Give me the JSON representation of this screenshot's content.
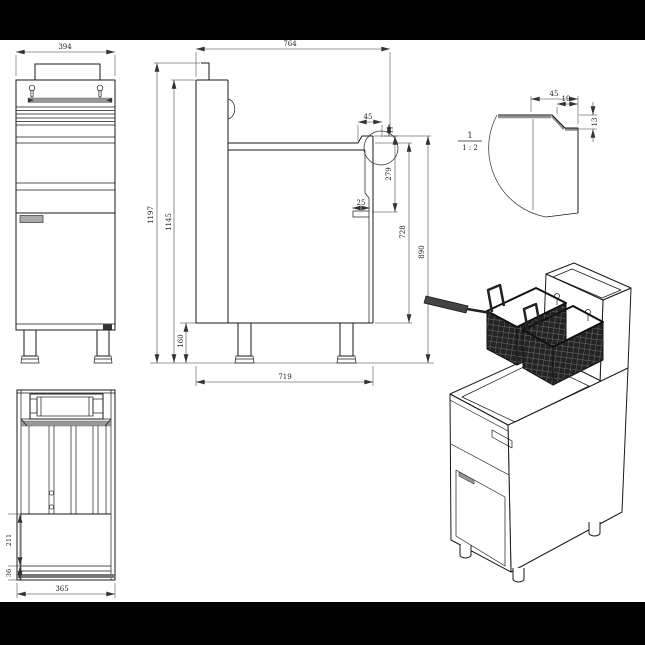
{
  "drawing": {
    "subject": "Commercial gas deep fryer - orthographic projection drawing with isometric view",
    "colors": {
      "line": "#1a1a1a",
      "dim_text": "#222222",
      "shade": "#999999",
      "basket": "#242424",
      "bar": "#000000"
    },
    "front_view": {
      "dim_width": "394"
    },
    "side_view": {
      "dim_top_depth": "764",
      "dim_overall_height": "1197",
      "dim_body_height": "1145",
      "dim_leg_height": "160",
      "dim_base_depth": "719",
      "dim_lip_width": "45",
      "dim_lip_edge": "13",
      "dim_panel_drop": "279",
      "dim_bracket_offset": "25",
      "dim_front_height": "728",
      "dim_work_height": "890"
    },
    "detail_view": {
      "label": "1",
      "scale": "1 : 2",
      "dim_lip_width": "45",
      "dim_inner_step": "19",
      "dim_edge_height": "13"
    },
    "plan_view": {
      "dim_front_depth": "211",
      "dim_edge": "36",
      "dim_width": "365"
    }
  }
}
